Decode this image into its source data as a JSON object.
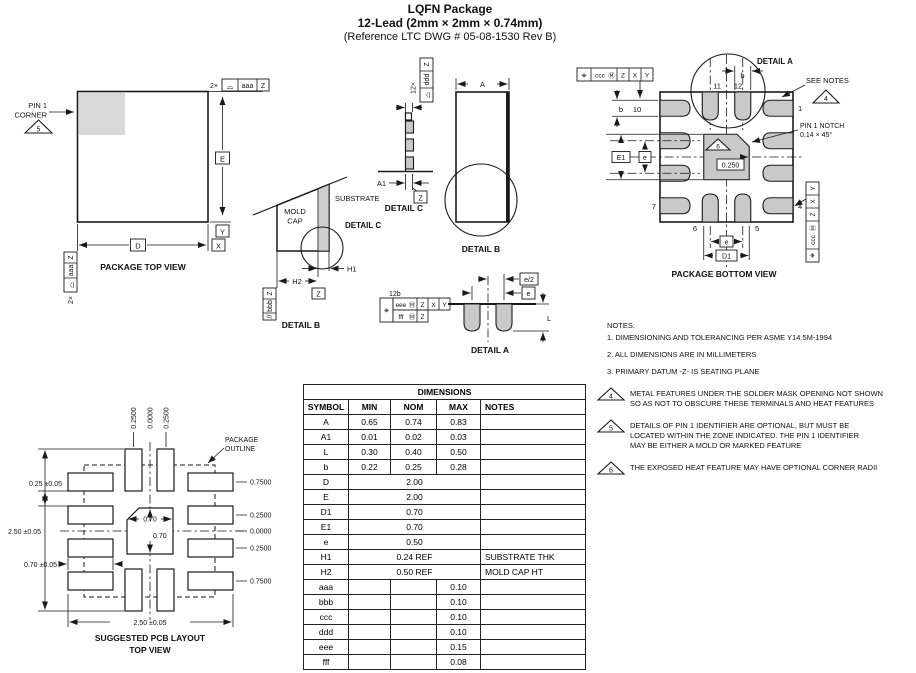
{
  "title": {
    "line1": "LQFN Package",
    "line2": "12-Lead (2mm × 2mm × 0.74mm)",
    "line3": "(Reference LTC DWG # 05-08-1530 Rev B)"
  },
  "colors": {
    "line": "#1a1a1a",
    "pad_fill": "#c9c9c9",
    "pin1_corner_fill": "#d9d9d9",
    "background": "#ffffff"
  },
  "symbols": {
    "position": "⌖",
    "profile": "⌓",
    "mmc": "Ⓜ",
    "parallel": "//"
  },
  "datums": {
    "x": "X",
    "y": "Y",
    "z": "Z"
  },
  "tolerances": {
    "aaa": "aaa",
    "bbb": "bbb",
    "ccc": "ccc",
    "ddd": "ddd",
    "eee": "eee",
    "fff": "fff"
  },
  "quantities": {
    "x2": "2×",
    "x12": "12×",
    "x12b": "12b"
  },
  "dims": {
    "a": "A",
    "a1": "A1",
    "d": "D",
    "e_cap": "E",
    "d1": "D1",
    "e1": "E1",
    "e": "e",
    "e_half": "e/2",
    "b": "b",
    "l": "L",
    "h1": "H1",
    "h2": "H2",
    "notch_zone": "0.250"
  },
  "flags": {
    "f4": "4",
    "f5": "5",
    "f6": "6"
  },
  "details": {
    "a": "DETAIL A",
    "b": "DETAIL B",
    "c": "DETAIL C"
  },
  "top_view": {
    "caption": "PACKAGE TOP VIEW",
    "pin1_line1": "PIN 1",
    "pin1_line2": "CORNER"
  },
  "detail_b_view": {
    "mold_line1": "MOLD",
    "mold_line2": "CAP",
    "substrate": "SUBSTRATE"
  },
  "bottom_view": {
    "caption": "PACKAGE BOTTOM VIEW",
    "see_notes": "SEE NOTES",
    "notch_line1": "PIN 1 NOTCH",
    "notch_line2": "0.14 × 45°",
    "pins": {
      "p1": "1",
      "p4": "4",
      "p5": "5",
      "p6": "6",
      "p7": "7",
      "p10": "10",
      "p11": "11",
      "p12": "12"
    }
  },
  "notes": {
    "heading": "NOTES:",
    "n1": "1. DIMENSIONING AND TOLERANCING PER ASME Y14.5M-1994",
    "n2": "2. ALL DIMENSIONS ARE IN MILLIMETERS",
    "n3": "3. PRIMARY DATUM -Z- IS SEATING PLANE",
    "n4a": "METAL FEATURES UNDER THE SOLDER MASK OPENING NOT SHOWN",
    "n4b": "SO AS NOT TO OBSCURE THESE TERMINALS AND HEAT FEATURES",
    "n5a": "DETAILS OF PIN 1 IDENTIFIER ARE OPTIONAL, BUT MUST BE",
    "n5b": "LOCATED WITHIN THE ZONE INDICATED. THE PIN 1 IDENTIFIER",
    "n5c": "MAY BE EITHER A MOLD OR MARKED FEATURE",
    "n6": "THE EXPOSED HEAT FEATURE MAY HAVE OPTIONAL CORNER RADII"
  },
  "table": {
    "title": "DIMENSIONS",
    "headers": [
      "SYMBOL",
      "MIN",
      "NOM",
      "MAX",
      "NOTES"
    ],
    "rows": [
      {
        "symbol": "A",
        "min": "0.65",
        "nom": "0.74",
        "max": "0.83",
        "notes": ""
      },
      {
        "symbol": "A1",
        "min": "0.01",
        "nom": "0.02",
        "max": "0.03",
        "notes": ""
      },
      {
        "symbol": "L",
        "min": "0.30",
        "nom": "0.40",
        "max": "0.50",
        "notes": ""
      },
      {
        "symbol": "b",
        "min": "0.22",
        "nom": "0.25",
        "max": "0.28",
        "notes": ""
      },
      {
        "symbol": "D",
        "span": "2.00",
        "notes": ""
      },
      {
        "symbol": "E",
        "span": "2.00",
        "notes": ""
      },
      {
        "symbol": "D1",
        "span": "0.70",
        "notes": ""
      },
      {
        "symbol": "E1",
        "span": "0.70",
        "notes": ""
      },
      {
        "symbol": "e",
        "span": "0.50",
        "notes": ""
      },
      {
        "symbol": "H1",
        "span": "0.24 REF",
        "notes": "SUBSTRATE THK"
      },
      {
        "symbol": "H2",
        "span": "0.50 REF",
        "notes": "MOLD CAP HT"
      },
      {
        "symbol": "aaa",
        "min": "",
        "nom": "",
        "max": "0.10",
        "notes": ""
      },
      {
        "symbol": "bbb",
        "min": "",
        "nom": "",
        "max": "0.10",
        "notes": ""
      },
      {
        "symbol": "ccc",
        "min": "",
        "nom": "",
        "max": "0.10",
        "notes": ""
      },
      {
        "symbol": "ddd",
        "min": "",
        "nom": "",
        "max": "0.10",
        "notes": ""
      },
      {
        "symbol": "eee",
        "min": "",
        "nom": "",
        "max": "0.15",
        "notes": ""
      },
      {
        "symbol": "fff",
        "min": "",
        "nom": "",
        "max": "0.08",
        "notes": ""
      }
    ]
  },
  "pcb": {
    "caption_line1": "SUGGESTED PCB LAYOUT",
    "caption_line2": "TOP VIEW",
    "outline_line1": "PACKAGE",
    "outline_line2": "OUTLINE",
    "col_left": "0.2500",
    "col_center": "0.0000",
    "col_right": "0.2500",
    "row_labels": [
      "0.7500",
      "0.2500",
      "0.0000",
      "0.2500",
      "0.7500"
    ],
    "gap_dim": "0.25 ±0.05",
    "height_dim": "2.50 ±0.05",
    "pad_len_dim": "0.70 ±0.05",
    "width_dim": "2.50 ±0.05",
    "center_w": "0.70",
    "center_h": "0.70"
  }
}
